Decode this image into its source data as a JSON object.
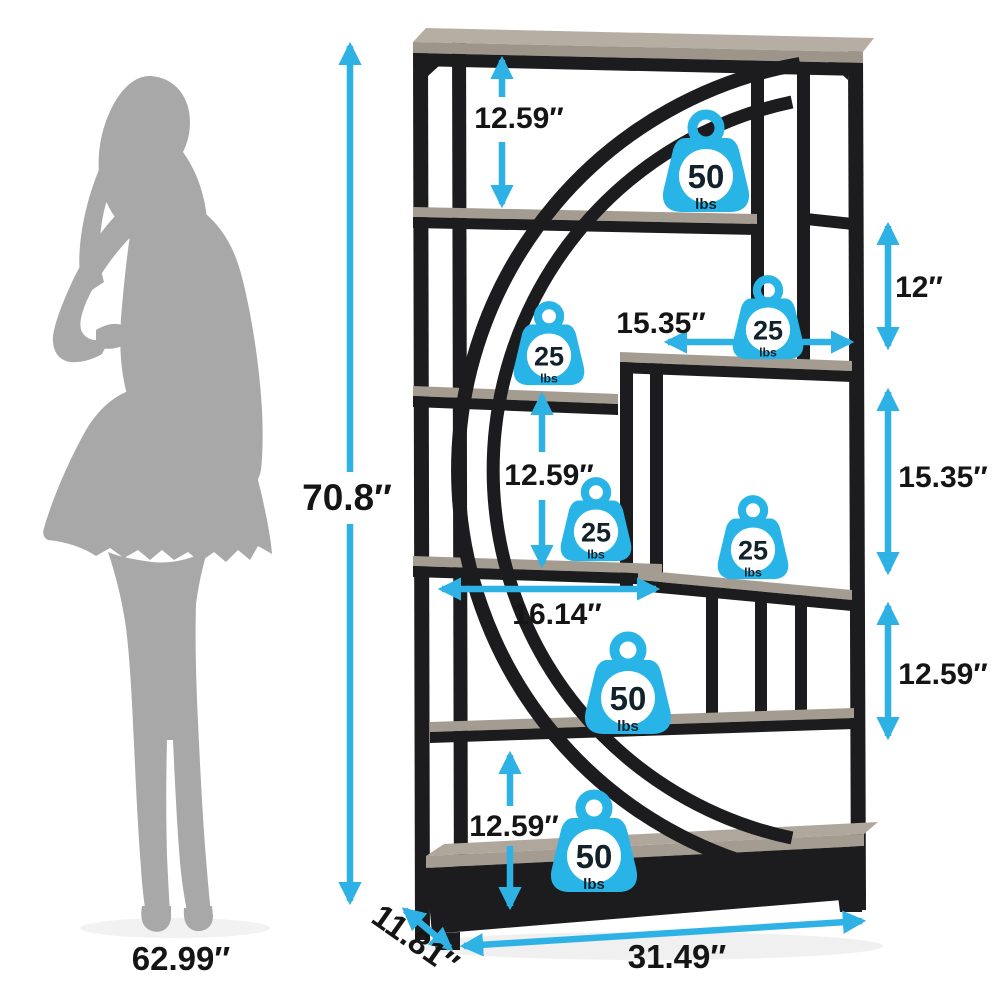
{
  "colors": {
    "accent_cyan": "#2eb2e6",
    "icon_blue": "#29b4e8",
    "frame_black": "#1c1c1e",
    "wood": "#a59c91",
    "wood_light": "#b6aea3",
    "silhouette_gray": "#a8a8a8",
    "label_black": "#151515"
  },
  "overall": {
    "height": "70.8″",
    "width": "31.49″",
    "depth": "11.81″"
  },
  "figure": {
    "height": "62.99″"
  },
  "gaps": {
    "top_shelf_gap": "12.59″",
    "left_middle_gap": "12.59″",
    "left_bottom_gap": "12.59″",
    "right_cubby_height": "12″",
    "right_middle_height": "15.35″",
    "right_lower_gap": "12.59″",
    "step_shelf_width": "15.35″",
    "middle_shelf_width": "16.14″"
  },
  "weights": [
    {
      "value": "50",
      "unit": "lbs",
      "location": "second shelf"
    },
    {
      "value": "25",
      "unit": "lbs",
      "location": "right step shelf"
    },
    {
      "value": "25",
      "unit": "lbs",
      "location": "left middle shelf"
    },
    {
      "value": "25",
      "unit": "lbs",
      "location": "left lower middle shelf"
    },
    {
      "value": "25",
      "unit": "lbs",
      "location": "right lower middle shelf"
    },
    {
      "value": "50",
      "unit": "lbs",
      "location": "seventh shelf"
    },
    {
      "value": "50",
      "unit": "lbs",
      "location": "bottom shelf"
    }
  ]
}
